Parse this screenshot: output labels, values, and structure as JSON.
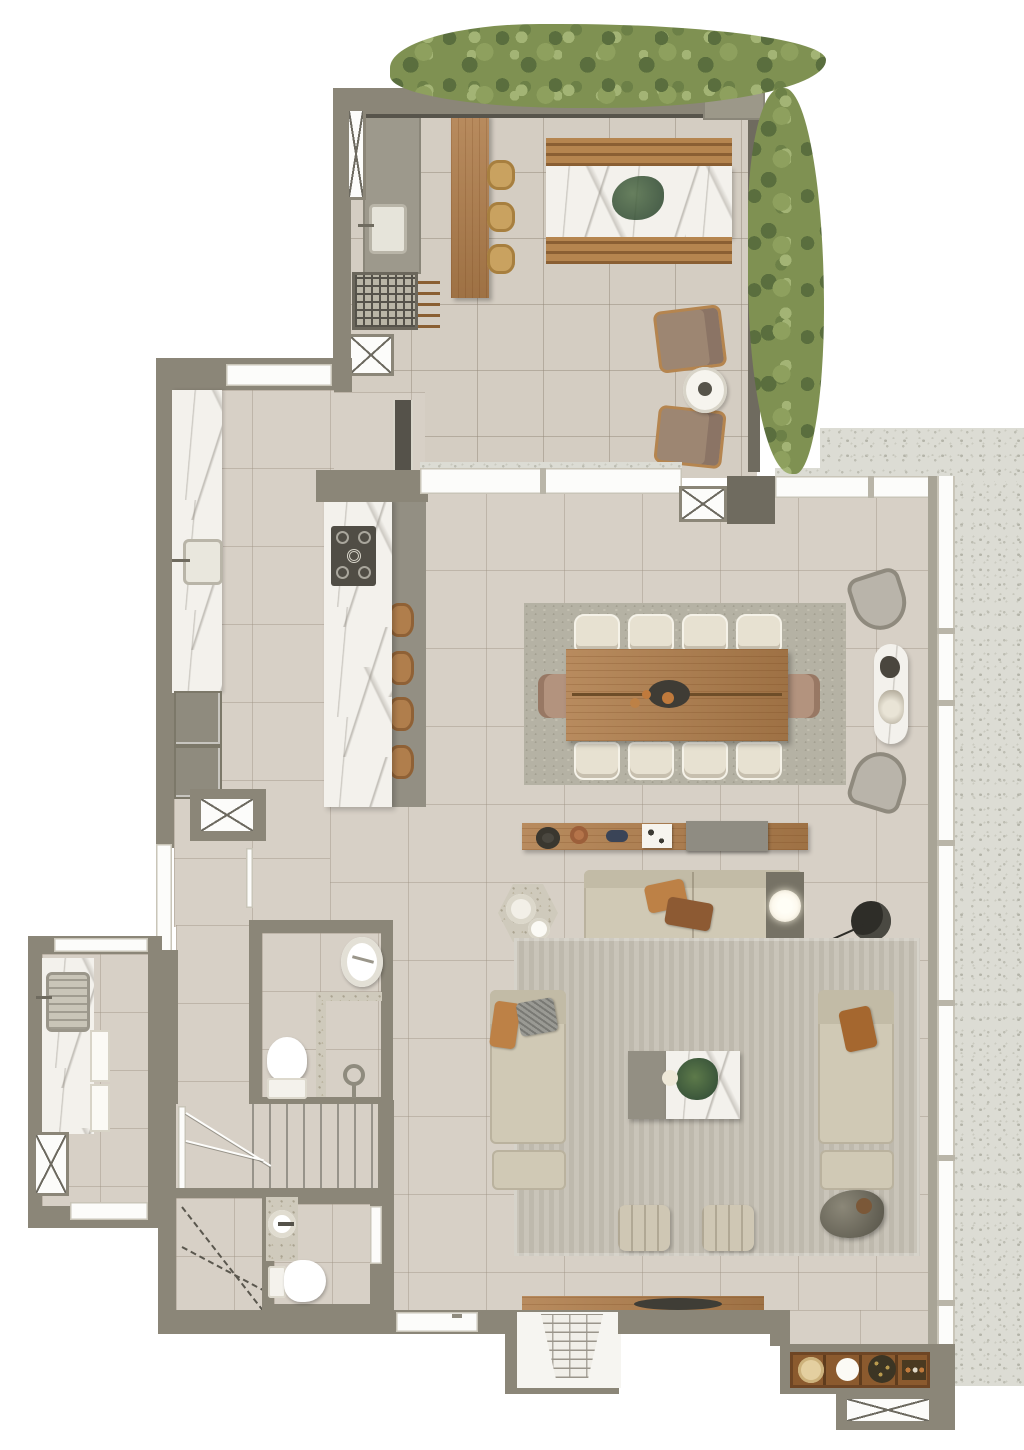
{
  "scene": {
    "kind": "residential-penthouse-floor-plan-render",
    "view": "top-down",
    "visible_text": "none"
  },
  "colors": {
    "outside": "#ffffff",
    "wall": "#8b8678",
    "wall_dark": "#6f6b5f",
    "wall_deep": "#55524a",
    "floor_main": "#d7d0c6",
    "floor_terrace": "#d4cdc2",
    "balcony_speckle": "#dcdcd4",
    "speckle_counter": "#cfcabc",
    "window_white": "#fcfcfa",
    "marble_base": "#f3f1ec",
    "wood": "#b07e4c",
    "wood_dark": "#8a5f33",
    "wicker": "#c9a260",
    "hedge_mid": "#7f9152",
    "hedge_dark": "#5a6e3e",
    "hedge_light": "#a3b475",
    "rug_dining": "#b5b2a4",
    "rug_living": "#c9c4b9",
    "sofa": "#d0c9b5",
    "chair_cream": "#e7e1d1",
    "cushion_orange": "#bd8146",
    "cushion_brown": "#8d5a33",
    "leather_tan": "#b3937e",
    "gray_furniture": "#938f83",
    "cooktop": "#504d45",
    "lamp_glow": "#fdf9ee",
    "black": "#2e2d28",
    "terracotta": "#b5744a"
  },
  "inventory": {
    "terrace": {
      "bar_stools": 3,
      "outdoor_benches": 2,
      "outdoor_marble_table": 1,
      "lounge_chairs": 2,
      "round_side_table": 1,
      "grill": 1,
      "outdoor_sink": 1
    },
    "kitchen": {
      "island_stools": 4,
      "cooktop_burners": 4,
      "sink": 1,
      "appliance_fronts": 2,
      "tall_cabinet": 1
    },
    "dining": {
      "side_chairs": 8,
      "end_chairs": 2,
      "fruit_bowl": 1
    },
    "window_nook": {
      "sling_chairs": 2,
      "capsule_marble_table": 1
    },
    "living": {
      "sofa_modules": 2,
      "chaise_units": 2,
      "ottomans": 2,
      "striped_poufs": 2,
      "coffee_table": 1,
      "hex_side_table": 1,
      "lamp_side_table": 1,
      "organic_side_table": 1,
      "arc_floor_lamp": 1,
      "media_console": 1,
      "entry_console": 1,
      "bar_cabinet_cells": 4
    },
    "bathroom_main": {
      "round_basin": 1,
      "toilet": 1,
      "shower": 1,
      "glass_partition": 1
    },
    "powder_room": {
      "basin": 1,
      "toilet": 1
    },
    "laundry": {
      "sink": 1,
      "appliance_fronts": 2
    },
    "stairs": {
      "straight_treads": 8,
      "winders": 3
    },
    "shaft_hatch_boxes": 6
  }
}
